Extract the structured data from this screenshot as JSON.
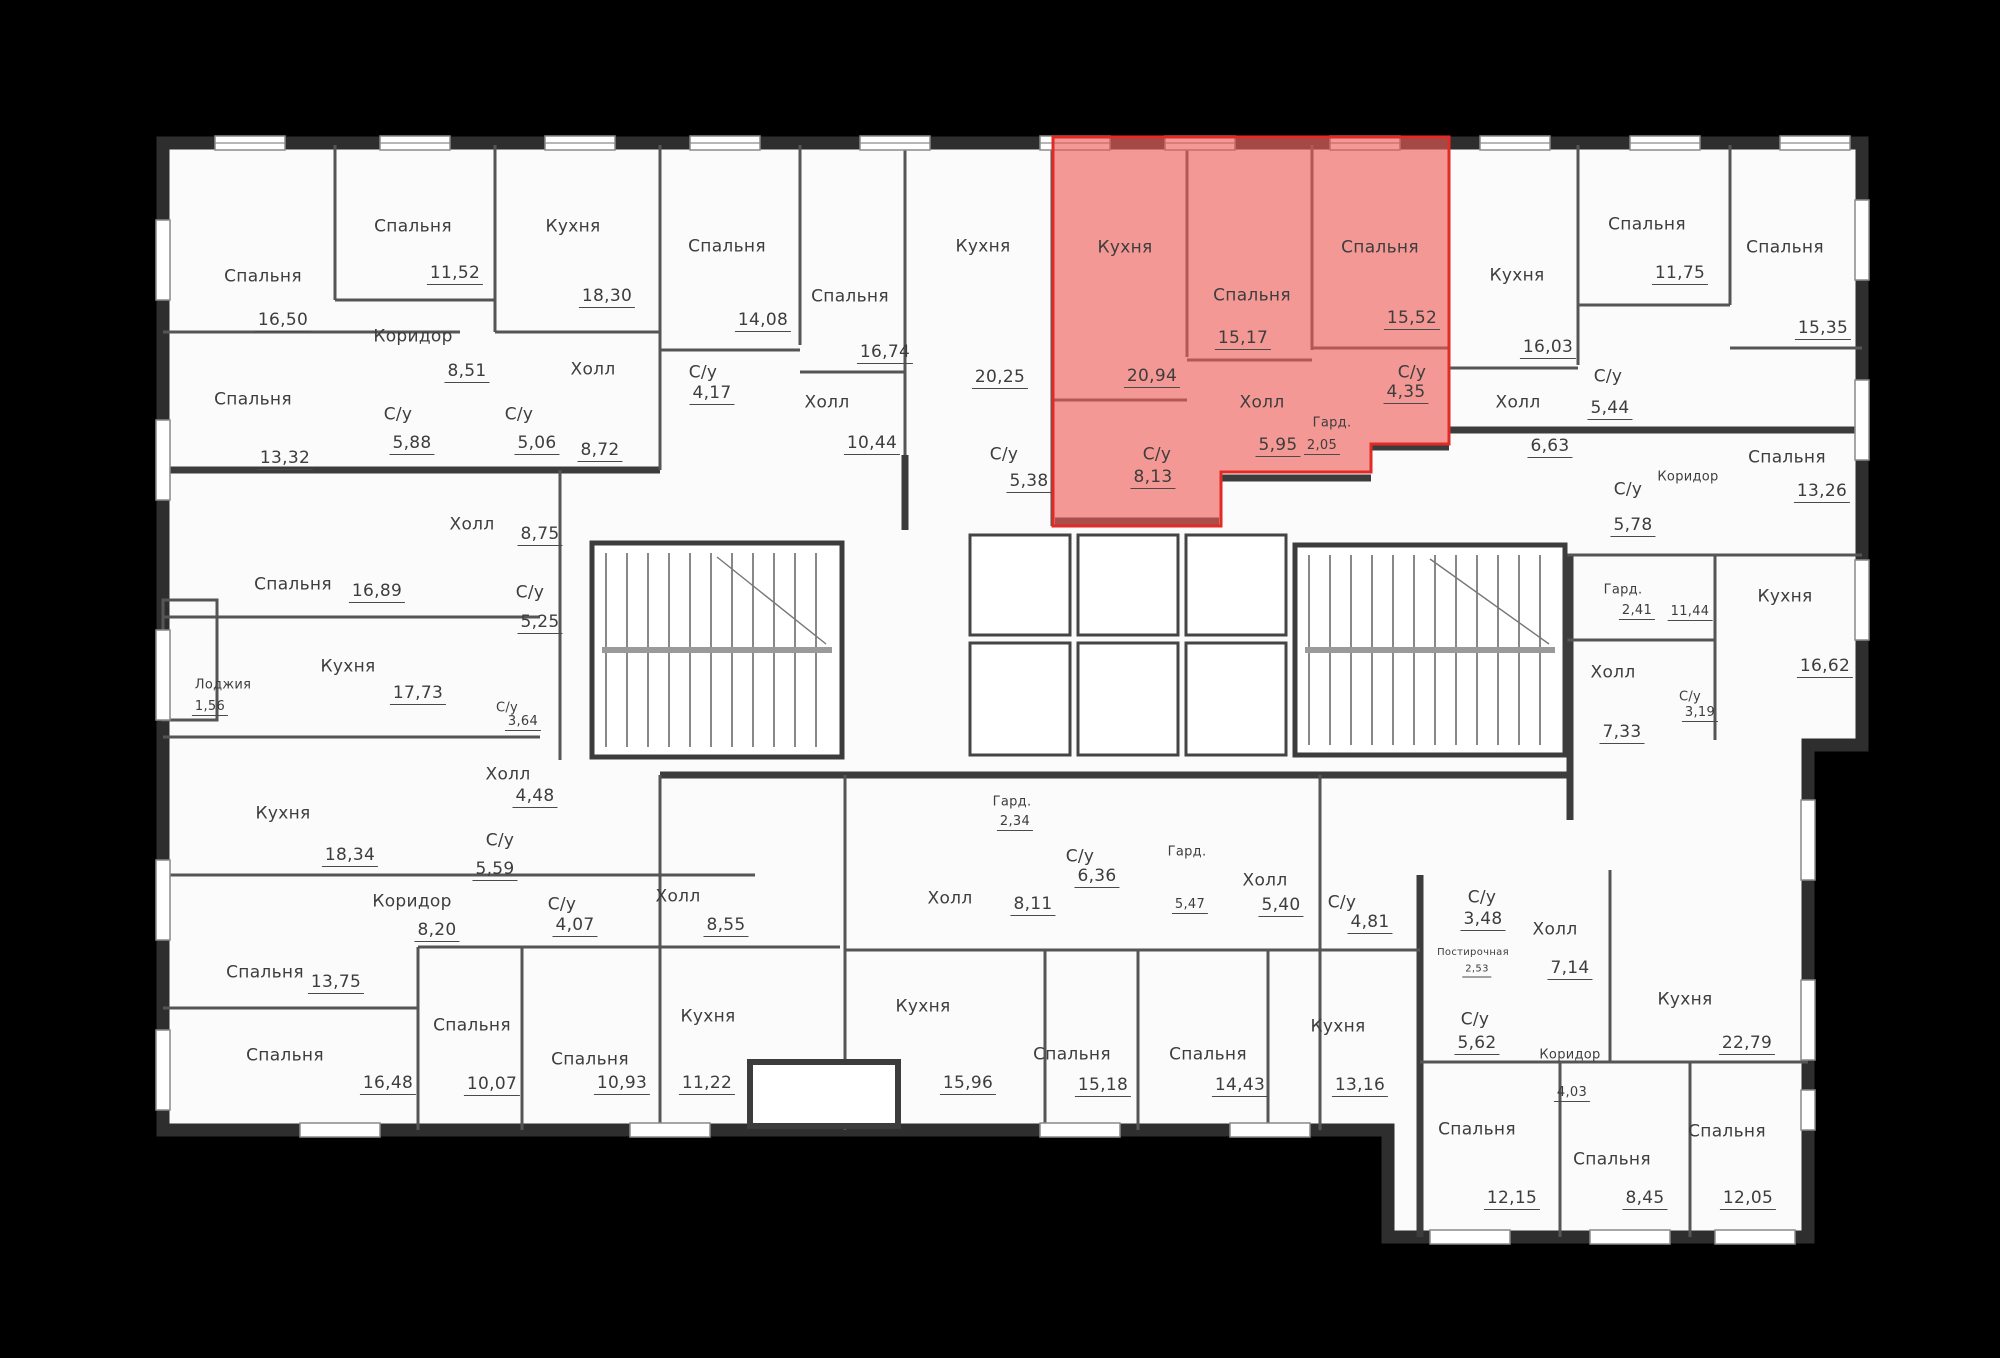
{
  "plan": {
    "type": "residential-floor-plan",
    "language": "ru",
    "background_color": "#000000",
    "paper_color": "#fbfbfb",
    "wall_color": "#2e2e2e",
    "highlight_fill": "#ee5a55",
    "highlight_border": "#e02b26",
    "highlighted_unit_rooms": [
      "Кухня 20,94",
      "Спальня 15,17",
      "Спальня 15,52",
      "Холл 5,95",
      "Гард. 2,05",
      "С/у 4,35",
      "С/у 8,13"
    ],
    "rooms": [
      {
        "name": "Спальня",
        "area": "16,50",
        "nx": 263,
        "ny": 277,
        "ax": 283,
        "ay": 322
      },
      {
        "name": "Спальня",
        "area": "11,52",
        "nx": 413,
        "ny": 227,
        "ax": 455,
        "ay": 275
      },
      {
        "name": "Кухня",
        "area": "18,30",
        "nx": 573,
        "ny": 227,
        "ax": 607,
        "ay": 298
      },
      {
        "name": "Коридор",
        "area": "8,51",
        "nx": 413,
        "ny": 337,
        "ax": 467,
        "ay": 373
      },
      {
        "name": "С/у",
        "area": "5,88",
        "nx": 398,
        "ny": 415,
        "ax": 412,
        "ay": 445
      },
      {
        "name": "С/у",
        "area": "5,06",
        "nx": 519,
        "ny": 415,
        "ax": 537,
        "ay": 445
      },
      {
        "name": "Холл",
        "area": "8,72",
        "nx": 593,
        "ny": 370,
        "ax": 600,
        "ay": 452
      },
      {
        "name": "Спальня",
        "area": "13,32",
        "nx": 253,
        "ny": 400,
        "ax": 285,
        "ay": 460
      },
      {
        "name": "Спальня",
        "area": "14,08",
        "nx": 727,
        "ny": 247,
        "ax": 763,
        "ay": 322
      },
      {
        "name": "Спальня",
        "area": "16,74",
        "nx": 850,
        "ny": 297,
        "ax": 885,
        "ay": 354
      },
      {
        "name": "Кухня",
        "area": "20,25",
        "nx": 983,
        "ny": 247,
        "ax": 1000,
        "ay": 379
      },
      {
        "name": "С/у",
        "area": "4,17",
        "nx": 703,
        "ny": 373,
        "ax": 712,
        "ay": 395
      },
      {
        "name": "Холл",
        "area": "10,44",
        "nx": 827,
        "ny": 403,
        "ax": 872,
        "ay": 445
      },
      {
        "name": "С/у",
        "area": "5,38",
        "nx": 1004,
        "ny": 455,
        "ax": 1029,
        "ay": 483
      },
      {
        "name": "Кухня",
        "area": "20,94",
        "nx": 1125,
        "ny": 248,
        "ax": 1152,
        "ay": 378,
        "h": true
      },
      {
        "name": "Спальня",
        "area": "15,17",
        "nx": 1252,
        "ny": 296,
        "ax": 1243,
        "ay": 340,
        "h": true
      },
      {
        "name": "Спальня",
        "area": "15,52",
        "nx": 1380,
        "ny": 248,
        "ax": 1412,
        "ay": 320,
        "h": true
      },
      {
        "name": "Холл",
        "area": "5,95",
        "nx": 1262,
        "ny": 403,
        "ax": 1278,
        "ay": 447,
        "h": true
      },
      {
        "name": "Гард.",
        "area": "2,05",
        "nx": 1332,
        "ny": 423,
        "ax": 1322,
        "ay": 447,
        "h": true,
        "size": "sm"
      },
      {
        "name": "С/у",
        "area": "4,35",
        "nx": 1412,
        "ny": 373,
        "ax": 1406,
        "ay": 394,
        "h": true
      },
      {
        "name": "С/у",
        "area": "8,13",
        "nx": 1157,
        "ny": 455,
        "ax": 1153,
        "ay": 479,
        "h": true
      },
      {
        "name": "Кухня",
        "area": "16,03",
        "nx": 1517,
        "ny": 276,
        "ax": 1548,
        "ay": 349
      },
      {
        "name": "Спальня",
        "area": "11,75",
        "nx": 1647,
        "ny": 225,
        "ax": 1680,
        "ay": 275
      },
      {
        "name": "Спальня",
        "area": "15,35",
        "nx": 1785,
        "ny": 248,
        "ax": 1823,
        "ay": 330
      },
      {
        "name": "С/у",
        "area": "5,44",
        "nx": 1608,
        "ny": 377,
        "ax": 1610,
        "ay": 410
      },
      {
        "name": "Холл",
        "area": "6,63",
        "nx": 1518,
        "ny": 403,
        "ax": 1550,
        "ay": 448
      },
      {
        "name": "Спальня",
        "area": "13,26",
        "nx": 1787,
        "ny": 458,
        "ax": 1822,
        "ay": 493
      },
      {
        "name": "С/у",
        "area": "5,78",
        "nx": 1628,
        "ny": 490,
        "ax": 1633,
        "ay": 527
      },
      {
        "name": "Коридор",
        "area": "11,44",
        "nx": 1688,
        "ny": 477,
        "ax": 1690,
        "ay": 613,
        "size": "sm"
      },
      {
        "name": "Гард.",
        "area": "2,41",
        "nx": 1623,
        "ny": 590,
        "ax": 1637,
        "ay": 612,
        "size": "sm"
      },
      {
        "name": "Кухня",
        "area": "16,62",
        "nx": 1785,
        "ny": 597,
        "ax": 1825,
        "ay": 668
      },
      {
        "name": "Холл",
        "area": "7,33",
        "nx": 1613,
        "ny": 673,
        "ax": 1622,
        "ay": 734
      },
      {
        "name": "С/у",
        "area": "3,19",
        "nx": 1690,
        "ny": 697,
        "ax": 1700,
        "ay": 714,
        "size": "sm"
      },
      {
        "name": "Спальня",
        "area": "16,89",
        "nx": 293,
        "ny": 585,
        "ax": 377,
        "ay": 593
      },
      {
        "name": "Холл",
        "area": "8,75",
        "nx": 472,
        "ny": 525,
        "ax": 540,
        "ay": 536
      },
      {
        "name": "С/у",
        "area": "5,25",
        "nx": 530,
        "ny": 593,
        "ax": 540,
        "ay": 624
      },
      {
        "name": "Кухня",
        "area": "17,73",
        "nx": 348,
        "ny": 667,
        "ax": 418,
        "ay": 695
      },
      {
        "name": "Лоджия",
        "area": "1,56",
        "nx": 223,
        "ny": 685,
        "ax": 210,
        "ay": 708,
        "size": "sm"
      },
      {
        "name": "С/у",
        "area": "3,64",
        "nx": 507,
        "ny": 708,
        "ax": 523,
        "ay": 723,
        "size": "sm"
      },
      {
        "name": "Холл",
        "area": "4,48",
        "nx": 508,
        "ny": 775,
        "ax": 535,
        "ay": 798
      },
      {
        "name": "Кухня",
        "area": "18,34",
        "nx": 283,
        "ny": 814,
        "ax": 350,
        "ay": 857
      },
      {
        "name": "С/у",
        "area": "5,59",
        "nx": 500,
        "ny": 841,
        "ax": 495,
        "ay": 871
      },
      {
        "name": "Коридор",
        "area": "8,20",
        "nx": 412,
        "ny": 902,
        "ax": 437,
        "ay": 932
      },
      {
        "name": "С/у",
        "area": "4,07",
        "nx": 562,
        "ny": 905,
        "ax": 575,
        "ay": 927
      },
      {
        "name": "Спальня",
        "area": "13,75",
        "nx": 265,
        "ny": 973,
        "ax": 336,
        "ay": 984
      },
      {
        "name": "Спальня",
        "area": "16,48",
        "nx": 285,
        "ny": 1056,
        "ax": 388,
        "ay": 1085
      },
      {
        "name": "Спальня",
        "area": "10,07",
        "nx": 472,
        "ny": 1026,
        "ax": 492,
        "ay": 1086
      },
      {
        "name": "Спальня",
        "area": "10,93",
        "nx": 590,
        "ny": 1060,
        "ax": 622,
        "ay": 1085
      },
      {
        "name": "Холл",
        "area": "8,55",
        "nx": 678,
        "ny": 897,
        "ax": 726,
        "ay": 927
      },
      {
        "name": "Кухня",
        "area": "11,22",
        "nx": 708,
        "ny": 1017,
        "ax": 707,
        "ay": 1085
      },
      {
        "name": "Гард.",
        "area": "2,34",
        "nx": 1012,
        "ny": 802,
        "ax": 1015,
        "ay": 823,
        "size": "sm"
      },
      {
        "name": "Холл",
        "area": "8,11",
        "nx": 950,
        "ny": 899,
        "ax": 1033,
        "ay": 906
      },
      {
        "name": "Кухня",
        "area": "15,96",
        "nx": 923,
        "ny": 1007,
        "ax": 968,
        "ay": 1085
      },
      {
        "name": "С/у",
        "area": "6,36",
        "nx": 1080,
        "ny": 857,
        "ax": 1097,
        "ay": 878
      },
      {
        "name": "Гард.",
        "area": "5,47",
        "nx": 1187,
        "ny": 852,
        "ax": 1190,
        "ay": 906,
        "size": "sm"
      },
      {
        "name": "Холл",
        "area": "5,40",
        "nx": 1265,
        "ny": 881,
        "ax": 1281,
        "ay": 907
      },
      {
        "name": "Спальня",
        "area": "15,18",
        "nx": 1072,
        "ny": 1055,
        "ax": 1103,
        "ay": 1087
      },
      {
        "name": "Спальня",
        "area": "14,43",
        "nx": 1208,
        "ny": 1055,
        "ax": 1240,
        "ay": 1087
      },
      {
        "name": "С/у",
        "area": "4,81",
        "nx": 1342,
        "ny": 903,
        "ax": 1370,
        "ay": 924
      },
      {
        "name": "С/у",
        "area": "3,48",
        "nx": 1482,
        "ny": 898,
        "ax": 1483,
        "ay": 921
      },
      {
        "name": "Постирочная",
        "area": "2,53",
        "nx": 1473,
        "ny": 953,
        "ax": 1477,
        "ay": 971,
        "size": "xs"
      },
      {
        "name": "Кухня",
        "area": "13,16",
        "nx": 1338,
        "ny": 1027,
        "ax": 1360,
        "ay": 1087
      },
      {
        "name": "С/у",
        "area": "5,62",
        "nx": 1475,
        "ny": 1020,
        "ax": 1477,
        "ay": 1045
      },
      {
        "name": "Холл",
        "area": "7,14",
        "nx": 1555,
        "ny": 930,
        "ax": 1570,
        "ay": 970
      },
      {
        "name": "Кухня",
        "area": "22,79",
        "nx": 1685,
        "ny": 1000,
        "ax": 1747,
        "ay": 1045
      },
      {
        "name": "Коридор",
        "area": "4,03",
        "nx": 1570,
        "ny": 1055,
        "ax": 1572,
        "ay": 1094,
        "size": "sm"
      },
      {
        "name": "Спальня",
        "area": "12,15",
        "nx": 1477,
        "ny": 1130,
        "ax": 1512,
        "ay": 1200
      },
      {
        "name": "Спальня",
        "area": "8,45",
        "nx": 1612,
        "ny": 1160,
        "ax": 1645,
        "ay": 1200
      },
      {
        "name": "Спальня",
        "area": "12,05",
        "nx": 1727,
        "ny": 1132,
        "ax": 1748,
        "ay": 1200
      }
    ]
  }
}
